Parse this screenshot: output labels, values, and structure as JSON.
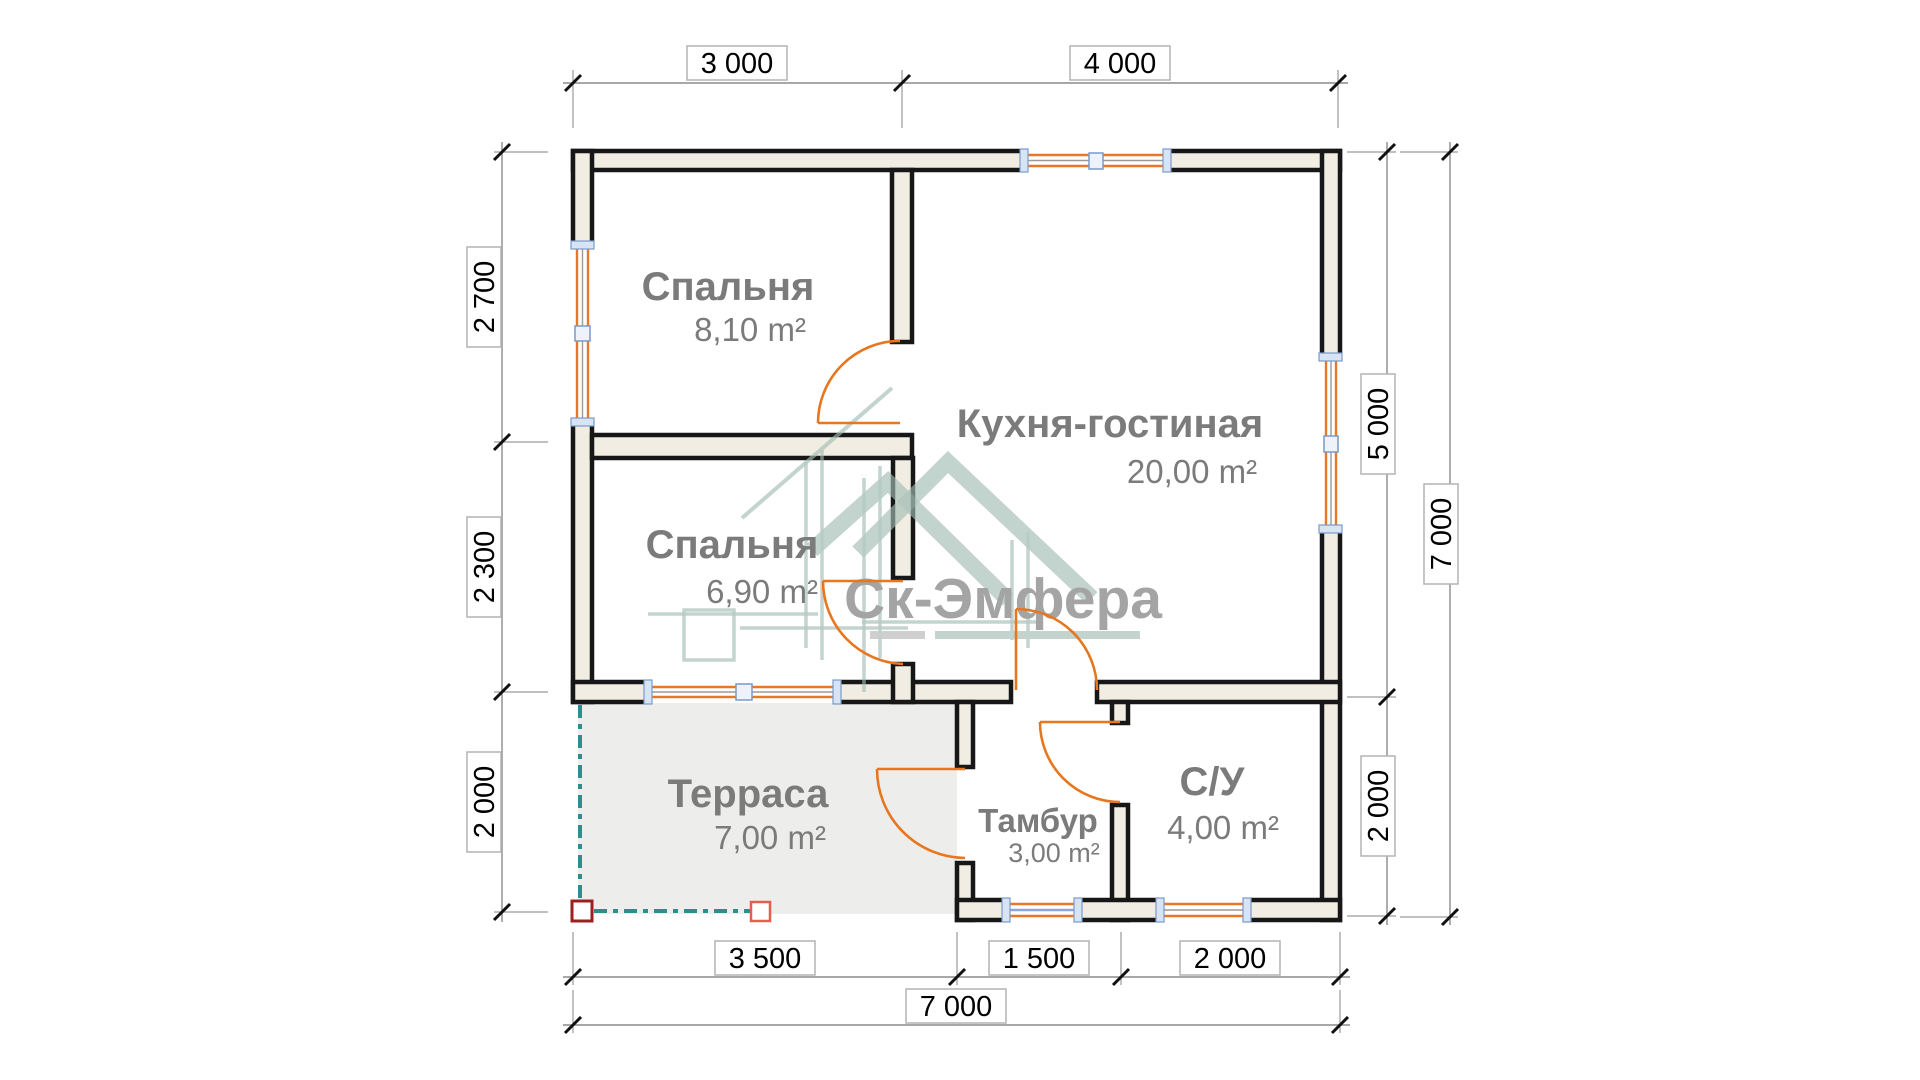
{
  "title": "Floor plan",
  "watermark": {
    "brand": "Ск-Эмфера"
  },
  "rooms": [
    {
      "name": "Спальня",
      "area": "8,10 m²"
    },
    {
      "name": "Спальня",
      "area": "6,90 m²"
    },
    {
      "name": "Кухня-гостиная",
      "area": "20,00 m²"
    },
    {
      "name": "Терраса",
      "area": "7,00 m²"
    },
    {
      "name": "Тамбур",
      "area": "3,00 m²"
    },
    {
      "name": "С/У",
      "area": "4,00 m²"
    }
  ],
  "dimensions": {
    "top": [
      "3 000",
      "4 000"
    ],
    "left": [
      "2 700",
      "2 300",
      "2 000"
    ],
    "right_inner": [
      "5 000",
      "2 000"
    ],
    "right_total": "7 000",
    "bottom": [
      "3 500",
      "1 500",
      "2 000"
    ],
    "bottom_total": "7 000"
  },
  "colors": {
    "wall_fill": "#f1ede2",
    "wall_stroke": "#171717",
    "opening_orange": "#e8761f",
    "terrace_fill": "#ededeb",
    "terrace_teal": "#2e8e8e",
    "post_dark_red": "#9e1f1f",
    "post_light_red": "#e2604e",
    "room_label_gray": "#7b7b7b",
    "watermark_sage": "#a2bdb5",
    "watermark_text_gray": "#a4a4a4"
  }
}
